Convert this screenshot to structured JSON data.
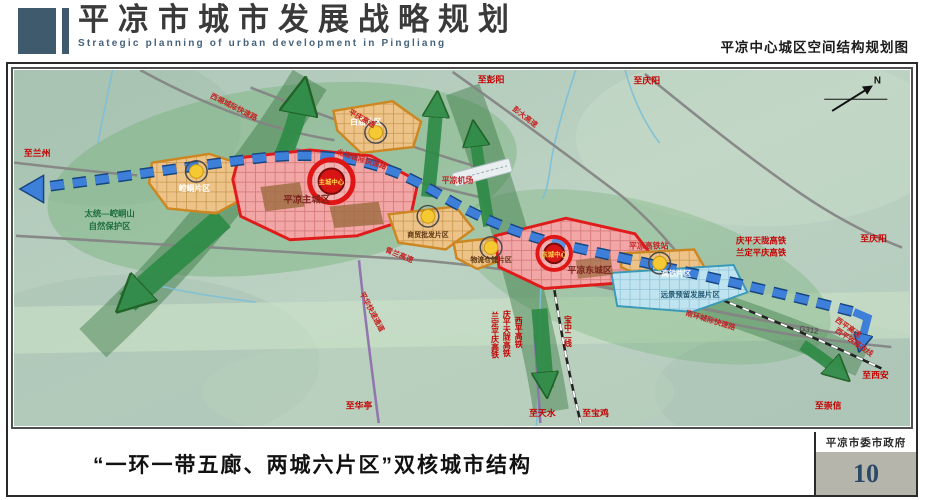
{
  "header": {
    "title_cn": "平凉市城市发展战略规划",
    "title_en": "Strategic planning of urban development in Pingliang",
    "map_subtitle": "平凉中心城区空间结构规划图"
  },
  "footer": {
    "caption": "“一环一带五廊、两城六片区”双核城市结构",
    "agency": "平凉市委市政府",
    "page_number": "10"
  },
  "colors": {
    "brand_slate": "#3f5a6d",
    "core_red": "#d81414",
    "zone_orange": "#eec387",
    "zone_pink": "#f2a6a6",
    "zone_blue": "#bfe4f0",
    "belt_blue": "#3d7fd9",
    "corridor_green": "#2e8b47",
    "page_number_blue": "#2c4a66"
  },
  "map": {
    "labels": [
      {
        "t": "至兰州",
        "x": 10,
        "y": 88,
        "c": "#c40000",
        "s": 9,
        "a": "start"
      },
      {
        "t": "崆峒片区",
        "x": 183,
        "y": 124,
        "c": "#ffffff",
        "s": 8
      },
      {
        "t": "太统—崆峒山",
        "x": 97,
        "y": 150,
        "c": "#1e6e3c",
        "s": 8.5
      },
      {
        "t": "自然保护区",
        "x": 97,
        "y": 163,
        "c": "#1e6e3c",
        "s": 8.5
      },
      {
        "t": "平凉主城区",
        "x": 297,
        "y": 136,
        "c": "#7c241c",
        "s": 9.5
      },
      {
        "t": "主城中心",
        "x": 322,
        "y": 117,
        "c": "#ffd54a",
        "s": 6.5
      },
      {
        "t": "白庙片区",
        "x": 357,
        "y": 56,
        "c": "#ffffff",
        "s": 8
      },
      {
        "t": "西塬城际快速路",
        "x": 222,
        "y": 40,
        "c": "#c42222",
        "s": 7.5,
        "r": 27
      },
      {
        "t": "平庆高速",
        "x": 352,
        "y": 52,
        "c": "#c42222",
        "s": 7.5,
        "r": 30
      },
      {
        "t": "北塬城际快速路",
        "x": 352,
        "y": 94,
        "c": "#c42222",
        "s": 7.5,
        "r": 17
      },
      {
        "t": "彭大高速",
        "x": 517,
        "y": 50,
        "c": "#c42222",
        "s": 7.5,
        "r": 38
      },
      {
        "t": "至彭阳",
        "x": 484,
        "y": 13,
        "c": "#c40000",
        "s": 9
      },
      {
        "t": "至庆阳",
        "x": 642,
        "y": 14,
        "c": "#c40000",
        "s": 9
      },
      {
        "t": "平凉机场",
        "x": 450,
        "y": 116,
        "c": "#c42222",
        "s": 8
      },
      {
        "t": "青兰高速",
        "x": 390,
        "y": 192,
        "c": "#c42222",
        "s": 7.5,
        "r": 22
      },
      {
        "t": "商贸批发片区",
        "x": 420,
        "y": 171,
        "c": "#5a3410",
        "s": 7
      },
      {
        "t": "物流仓储片区",
        "x": 484,
        "y": 197,
        "c": "#5a3410",
        "s": 7
      },
      {
        "t": "东城中心",
        "x": 548,
        "y": 191,
        "c": "#ffd54a",
        "s": 6.5
      },
      {
        "t": "平凉东城区",
        "x": 584,
        "y": 208,
        "c": "#7c241c",
        "s": 9
      },
      {
        "t": "平凉高铁站",
        "x": 644,
        "y": 183,
        "c": "#c42222",
        "s": 8
      },
      {
        "t": "高铁片区",
        "x": 672,
        "y": 211,
        "c": "#ffffff",
        "s": 7.5
      },
      {
        "t": "远景预留发展片区",
        "x": 686,
        "y": 233,
        "c": "#235a74",
        "s": 7.5
      },
      {
        "t": "南环城际快速路",
        "x": 706,
        "y": 259,
        "c": "#c42222",
        "s": 7.5,
        "r": 17
      },
      {
        "t": "G312",
        "x": 806,
        "y": 269,
        "c": "#555555",
        "s": 8,
        "r": 10
      },
      {
        "t": "庆平天陇高铁",
        "x": 758,
        "y": 178,
        "c": "#c40000",
        "s": 8.5
      },
      {
        "t": "兰定平庆高铁",
        "x": 758,
        "y": 190,
        "c": "#c40000",
        "s": 8.5
      },
      {
        "t": "至庆阳",
        "x": 872,
        "y": 176,
        "c": "#c40000",
        "s": 9
      },
      {
        "t": "西平高速",
        "x": 845,
        "y": 266,
        "c": "#c42222",
        "s": 7.5,
        "r": 35
      },
      {
        "t": "西平铁路改线",
        "x": 851,
        "y": 281,
        "c": "#c42222",
        "s": 7.5,
        "r": 35
      },
      {
        "t": "至西安",
        "x": 874,
        "y": 316,
        "c": "#c40000",
        "s": 9
      },
      {
        "t": "至崇信",
        "x": 826,
        "y": 347,
        "c": "#c40000",
        "s": 9
      },
      {
        "t": "平华快速通道",
        "x": 361,
        "y": 249,
        "c": "#c42222",
        "s": 7.5,
        "r": 62
      },
      {
        "t": "至华亭",
        "x": 350,
        "y": 347,
        "c": "#c40000",
        "s": 9
      },
      {
        "t": "至天水",
        "x": 536,
        "y": 355,
        "c": "#c40000",
        "s": 9
      },
      {
        "t": "至宝鸡",
        "x": 590,
        "y": 355,
        "c": "#c40000",
        "s": 9
      },
      {
        "t": "西平高铁",
        "x": 512,
        "y": 253,
        "c": "#c40000",
        "s": 8,
        "v": 1
      },
      {
        "t": "庆平天陇高铁",
        "x": 500,
        "y": 246,
        "c": "#c40000",
        "s": 8,
        "v": 1
      },
      {
        "t": "兰定平庆高铁",
        "x": 488,
        "y": 248,
        "c": "#c40000",
        "s": 8,
        "v": 1
      },
      {
        "t": "宝中二线",
        "x": 562,
        "y": 252,
        "c": "#c40000",
        "s": 8,
        "v": 1
      },
      {
        "t": "N",
        "x": 876,
        "y": 14,
        "c": "#111111",
        "s": 10
      }
    ]
  }
}
